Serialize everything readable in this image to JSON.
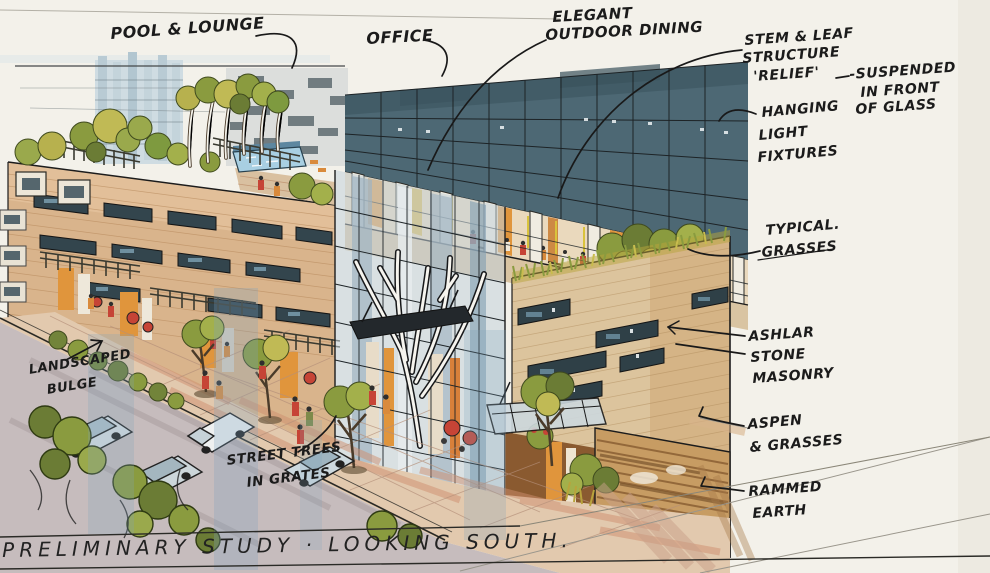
{
  "image": {
    "kind": "hand-drawn architectural concept rendering (marker and ink on paper)",
    "subject": "mixed-use building street perspective"
  },
  "title": {
    "text": "PRELIMINARY STUDY · LOOKING SOUTH."
  },
  "annotations": {
    "pool_lounge": {
      "text": "POOL & LOUNGE"
    },
    "office": {
      "text": "OFFICE"
    },
    "outdoor_dining": {
      "lines": [
        "ELEGANT",
        "OUTDOOR DINING"
      ]
    },
    "stem_leaf": {
      "lines": [
        "STEM & LEAF",
        "STRUCTURE",
        "'RELIEF'"
      ]
    },
    "suspended": {
      "lines": [
        "-SUSPENDED",
        "IN FRONT",
        "OF GLASS"
      ]
    },
    "hanging_lights": {
      "lines": [
        "HANGING",
        "LIGHT",
        "FIXTURES"
      ]
    },
    "typical_grasses": {
      "lines": [
        "TYPICAL.",
        "GRASSES"
      ]
    },
    "ashlar": {
      "lines": [
        "ASHLAR",
        "STONE",
        "MASONRY"
      ]
    },
    "aspen": {
      "lines": [
        "ASPEN",
        "& GRASSES"
      ]
    },
    "rammed_earth": {
      "lines": [
        "RAMMED",
        "EARTH"
      ]
    },
    "landscaped_bulge": {
      "lines": [
        "LANDSCAPED",
        "BULGE"
      ]
    },
    "street_trees": {
      "lines": [
        "STREET TREES",
        "IN GRATES"
      ]
    }
  },
  "colors": {
    "paper": "#f3f1ea",
    "ink": "#1c1c1c",
    "glass_dark": "#4d6874",
    "glass_light": "#c3d2da",
    "masonry_tan": "#d9b48c",
    "stone_tan": "#dcc49d",
    "rammed_earth": "#c79c63",
    "foliage_green": "#8a9b3f",
    "foliage_olive": "#6b7c35",
    "foliage_yellow": "#c8bc4e",
    "accent_orange": "#e0953c",
    "accent_red": "#c64436",
    "pool_blue": "#a8cfe2",
    "road_gray": "#c6bcbd",
    "paving_tan": "#e2c9ae"
  }
}
